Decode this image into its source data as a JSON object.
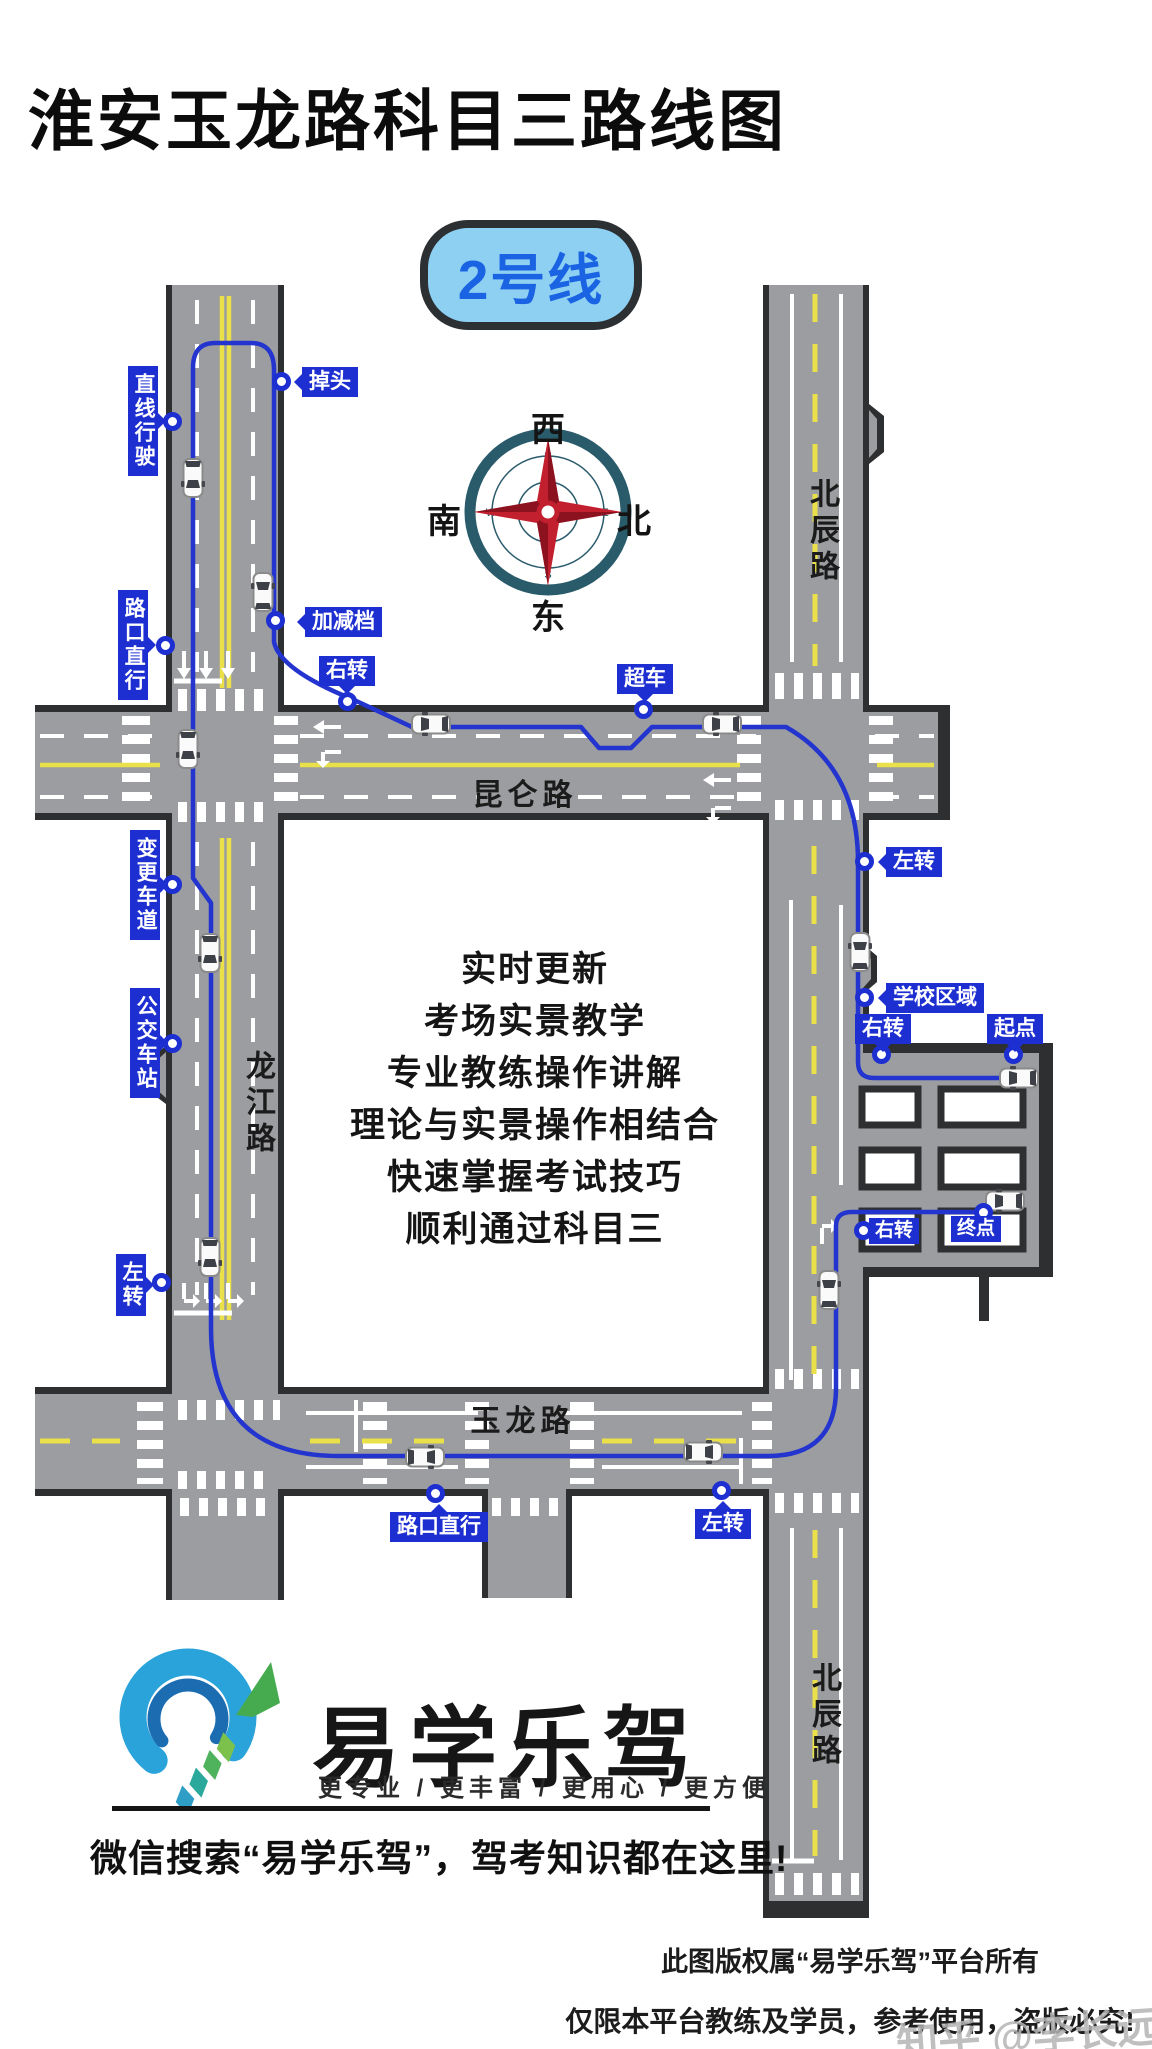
{
  "title": "淮安玉龙路科目三路线图",
  "badge": {
    "label": "2号线"
  },
  "compass": {
    "top": "西",
    "left": "南",
    "right": "北",
    "bottom": "东",
    "ring": {
      "n": "N",
      "e": "E",
      "s": "S",
      "w": "W"
    }
  },
  "roads": {
    "kunlun": "昆仑路",
    "beichen_top": "北辰路",
    "longjiang": "龙江路",
    "yulong": "玉龙路",
    "beichen_bottom": "北辰路"
  },
  "route_labels": [
    {
      "text": "掉头"
    },
    {
      "text": "直线行驶"
    },
    {
      "text": "路口直行"
    },
    {
      "text": "加减档"
    },
    {
      "text": "右转"
    },
    {
      "text": "超车"
    },
    {
      "text": "左转"
    },
    {
      "text": "学校区域"
    },
    {
      "text": "右转"
    },
    {
      "text": "起点"
    },
    {
      "text": "变更车道"
    },
    {
      "text": "公交车站"
    },
    {
      "text": "右转"
    },
    {
      "text": "终点"
    },
    {
      "text": "左转"
    },
    {
      "text": "路口直行"
    },
    {
      "text": "左转"
    }
  ],
  "promo_lines": [
    "实时更新",
    "考场实景教学",
    "专业教练操作讲解",
    "理论与实景操作相结合",
    "快速掌握考试技巧",
    "顺利通过科目三"
  ],
  "brand": {
    "name": "易学乐驾",
    "tagline": "更专业 / 更丰富 / 更用心 / 更方便",
    "wechat_line": "微信搜索“易学乐驾”，驾考知识都在这里!"
  },
  "footer": {
    "line1": "此图版权属“易学乐驾”平台所有",
    "line2": "仅限本平台教练及学员，参考使用，盗版必究!",
    "watermark": "知乎 @李长远"
  },
  "colors": {
    "road": "#9b9da0",
    "road_border": "#2d2f31",
    "lane_yellow": "#eae14a",
    "route_blue": "#2334cf",
    "label_blue": "#1e2fd2",
    "badge_bg": "#8dd0f2",
    "badge_text": "#1a64e4",
    "compass_ring": "#2a5b6b",
    "compass_star": "#c2202e"
  }
}
